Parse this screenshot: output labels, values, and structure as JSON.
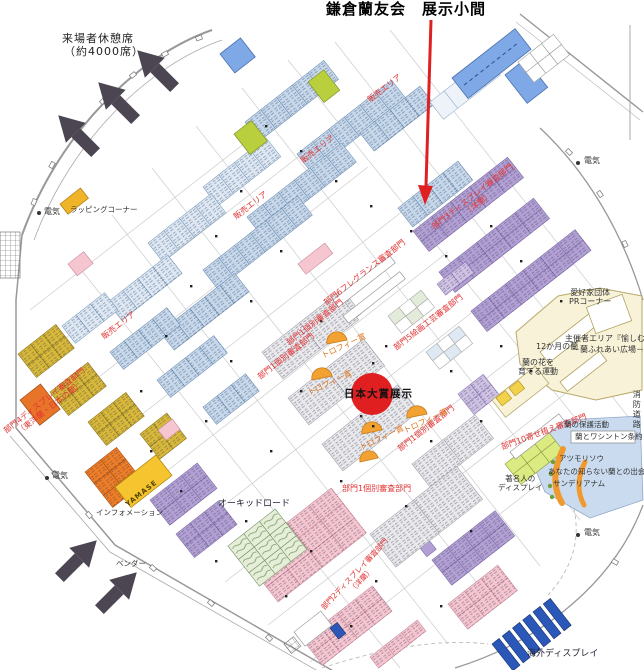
{
  "title": "鎌倉蘭友会　展示小間",
  "map": {
    "visitor_rest": {
      "line1": "来場者休憩席",
      "line2": "（約4000席）"
    },
    "zones": {
      "sales": "販売エリア",
      "dept1": "部門1個別審査部門",
      "dept2_line1": "部門2ディスプレイ審査部門",
      "dept2_line2": "（洋蘭）",
      "dept3_line1": "部門3ディスプレイ審査部門",
      "dept3_line2": "（洋蘭）",
      "dept4_line1": "部門4ディスプレイ審査部門",
      "dept4_line2": "（東洋蘭・日本の蘭）",
      "dept5": "部門5絵画工芸審査部門",
      "dept6": "部門6フレグランス審査部門",
      "dept10": "部門10寄せ植え審査部門",
      "orchid_road": "オーキッドロード",
      "overseas_display": "海外ディスプレイ"
    },
    "center": {
      "trophy": "トロフィー賞",
      "grand_prize": "日本大賞展示"
    },
    "organizer": {
      "fan_pr_line1": "愛好家団体",
      "fan_pr_line2": "PRコーナー",
      "area_line1": "主催者エリア『愉しむ』",
      "area_line2": "－蘭ふれあい広場－",
      "twelve_months": "12か月の蘭",
      "grow_line1": "蘭の花を",
      "grow_line2": "育てる運動"
    },
    "discover": {
      "protection": "蘭の保護活動",
      "washington": "蘭とワシントン条約",
      "atsumorisou": "アツモリソウ",
      "encounter": "あなたの知らない蘭との出会い",
      "sanderianum": "サンデリアナム",
      "celebrity_line1": "著名人の",
      "celebrity_line2": "ディスプレイ"
    },
    "facilities": {
      "wrapping": "ラッピングコーナー",
      "information": "インフォメーション",
      "vendor": "ベンダー",
      "electric": "電気",
      "fire_road": "消防道路"
    },
    "booths": {
      "yamase": "YAMASE"
    }
  },
  "colors": {
    "highlight_arrow": "#e02020",
    "grand_prize_circle": "#e02020",
    "sales_booth_blue": "#c6d9ec",
    "dept3_purple": "#b2a0d4",
    "dept2_pink": "#f6c6d0",
    "dept4_yellow": "#d8b838",
    "dept4_orange": "#ef7d26",
    "organizer_cream": "#f8f3d8",
    "discover_blue": "#cadbef",
    "dept10_green": "#dcea82",
    "overseas_blue": "#2b57b8",
    "entrance_arrow": "#4b4651"
  }
}
